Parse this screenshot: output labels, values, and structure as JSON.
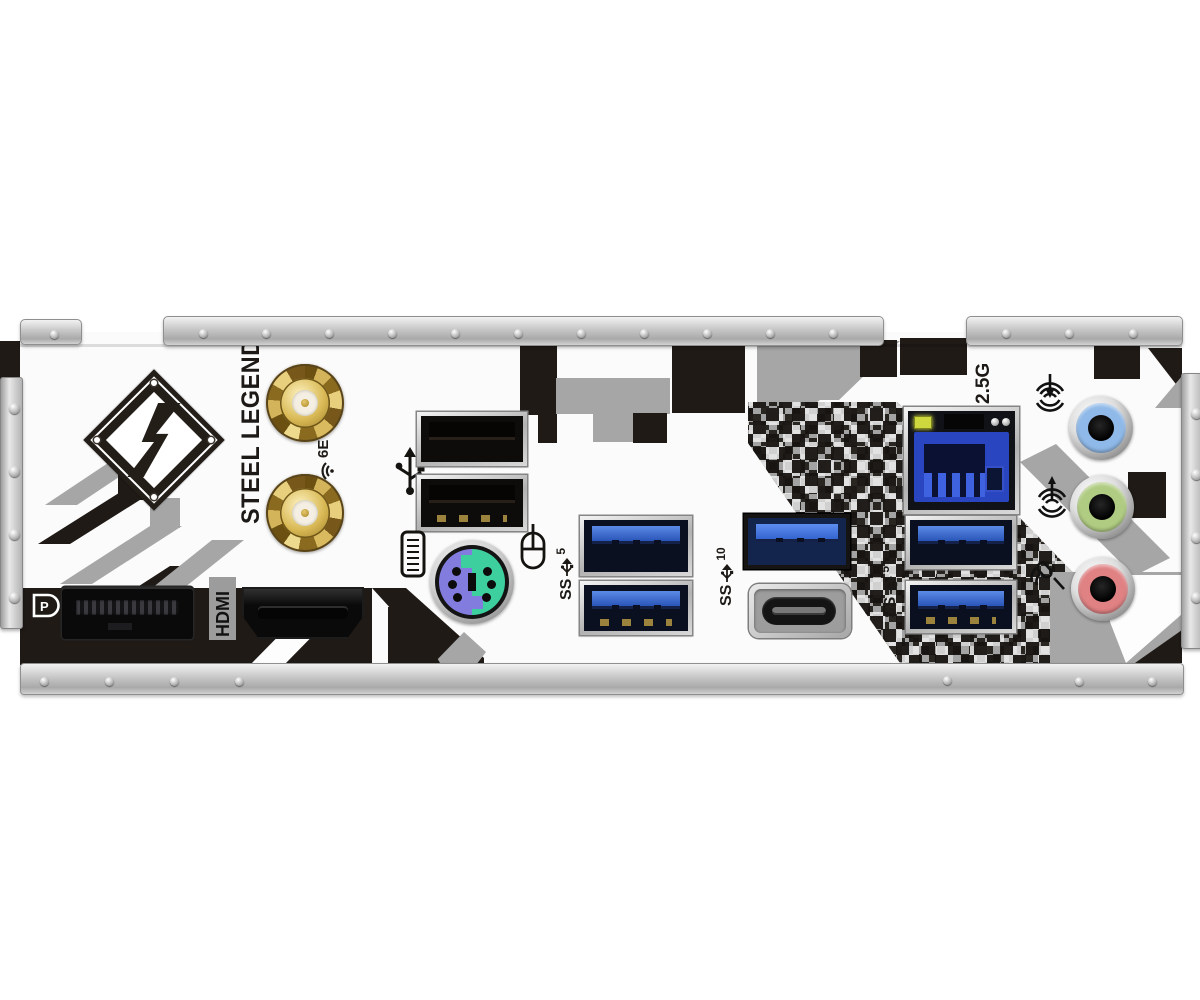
{
  "panel": {
    "brand_text": "STEEL LEGEND",
    "labels": {
      "lan_speed": "2.5G",
      "hdmi": "HDMI",
      "dp": "P",
      "wifi": "6E",
      "usb_mid": {
        "ss": "SS",
        "speed": "5"
      },
      "usb_gen2": {
        "ss": "SS",
        "speed": "10"
      },
      "usb_right": {
        "ss": "SS",
        "speed": "5"
      }
    },
    "icons": [
      "steel-legend-s-logo",
      "usb-2-icon",
      "keyboard-icon",
      "mouse-icon",
      "wifi-6e-icon",
      "usb-ss-arrow-icon",
      "line-in-icon",
      "line-out-icon",
      "mic-icon",
      "displayport-logo-icon"
    ],
    "ports": [
      {
        "name": "wifi-antenna-connector-top"
      },
      {
        "name": "wifi-antenna-connector-bottom"
      },
      {
        "name": "usb2-port-top"
      },
      {
        "name": "usb2-port-bottom"
      },
      {
        "name": "ps2-combo-port"
      },
      {
        "name": "displayport"
      },
      {
        "name": "hdmi-port"
      },
      {
        "name": "usb3-5gbps-port-top"
      },
      {
        "name": "usb3-5gbps-port-bottom"
      },
      {
        "name": "usb3-10gbps-type-a-port"
      },
      {
        "name": "usb-type-c-port"
      },
      {
        "name": "lan-rj45-port"
      },
      {
        "name": "usb3-5gbps-right-port-top"
      },
      {
        "name": "usb3-5gbps-right-port-bottom"
      },
      {
        "name": "audio-line-in-jack"
      },
      {
        "name": "audio-line-out-jack"
      },
      {
        "name": "audio-mic-jack"
      }
    ],
    "colors": {
      "camo_black": "#1f1a16",
      "camo_gray": "#a6a6a6",
      "usb3_blue": "#2d62c4",
      "lan_blue": "#2946c0",
      "led_green": "#ccd83e",
      "ps2_purple": "#837cdf",
      "ps2_green": "#3ecf9f",
      "antenna_gold": "#caa343",
      "jack_line_in": "#8fb9e8",
      "jack_line_out": "#b0cc82",
      "jack_mic": "#e08183",
      "metal": "#c7c7c7"
    }
  }
}
